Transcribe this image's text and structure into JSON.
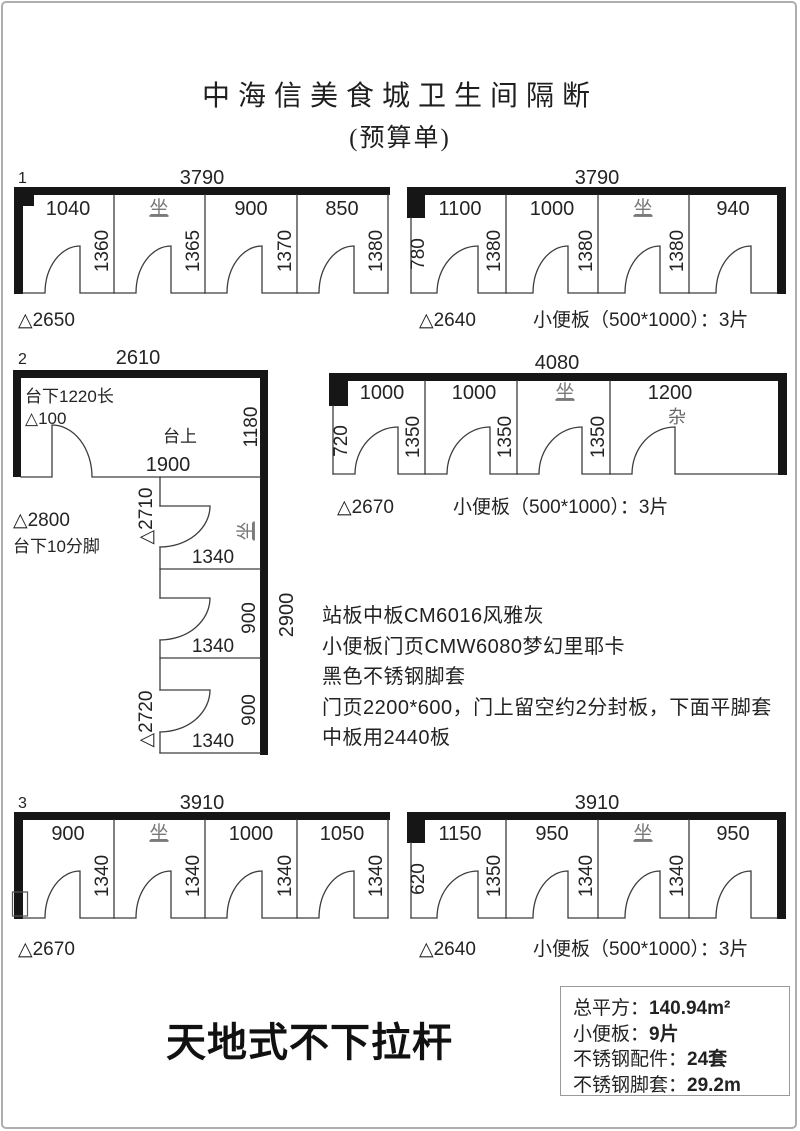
{
  "title": {
    "line1": "中海信美食城卫生间隔断",
    "line2": "(预算单)"
  },
  "ink_color": "#161616",
  "frame_color": "#aeaeae",
  "diagrams": {
    "d1": {
      "num": "1",
      "width_total": "3790",
      "floor_height": "△2650",
      "stalls": [
        {
          "w": "1040",
          "h": "1360"
        },
        {
          "w": "坐",
          "h": "1365"
        },
        {
          "w": "900",
          "h": "1370"
        },
        {
          "w": "850",
          "h": "1380"
        }
      ]
    },
    "d1r": {
      "width_total": "3790",
      "left_h": "780",
      "floor_height": "△2640",
      "urinal": "小便板（500*1000）：3片",
      "stalls": [
        {
          "w": "1100",
          "h": "1380"
        },
        {
          "w": "1000",
          "h": "1380"
        },
        {
          "w": "坐",
          "h": "1380"
        },
        {
          "w": "940",
          "h": ""
        }
      ]
    },
    "d2": {
      "num": "2",
      "width_total": "2610",
      "labels": {
        "under_counter": "台下1220长",
        "delta100": "△100",
        "counter_top": "台上",
        "right_h": "1180",
        "inner_w": "1900",
        "delta2800": "△2800",
        "feet": "台下10分脚",
        "delta2710": "△2710",
        "delta2720": "△2720",
        "col_h": "2900",
        "seat": "坐"
      },
      "stalls": [
        {
          "front": "1340",
          "side": ""
        },
        {
          "front": "1340",
          "side": "900"
        },
        {
          "front": "1340",
          "side": "900"
        }
      ]
    },
    "d2r": {
      "width_total": "4080",
      "left_h": "720",
      "floor_height": "△2670",
      "urinal": "小便板（500*1000）：3片",
      "misc": "杂",
      "stalls": [
        {
          "w": "1000",
          "h": "1350"
        },
        {
          "w": "1000",
          "h": "1350"
        },
        {
          "w": "坐",
          "h": "1350"
        },
        {
          "w": "1200",
          "h": ""
        }
      ]
    },
    "d3": {
      "num": "3",
      "width_total": "3910",
      "floor_height": "△2670",
      "stalls": [
        {
          "w": "900",
          "h": "1340"
        },
        {
          "w": "坐",
          "h": "1340"
        },
        {
          "w": "1000",
          "h": "1340"
        },
        {
          "w": "1050",
          "h": "1340"
        }
      ]
    },
    "d3r": {
      "width_total": "3910",
      "left_h": "620",
      "floor_height": "△2640",
      "urinal": "小便板（500*1000）：3片",
      "stalls": [
        {
          "w": "1150",
          "h": "1350"
        },
        {
          "w": "950",
          "h": "1340"
        },
        {
          "w": "坐",
          "h": "1340"
        },
        {
          "w": "950",
          "h": ""
        }
      ]
    }
  },
  "notes": {
    "lines": [
      "站板中板CM6016风雅灰",
      "小便板门页CMW6080梦幻里耶卡",
      "黑色不锈钢脚套",
      "门页2200*600，门上留空约2分封板，下面平脚套",
      "中板用2440板"
    ]
  },
  "footer": {
    "style_note": "天地式不下拉杆"
  },
  "summary": {
    "rows": [
      {
        "label": "总平方：",
        "value": "140.94m²"
      },
      {
        "label": "小便板：",
        "value": "9片"
      },
      {
        "label": "不锈钢配件：",
        "value": "24套"
      },
      {
        "label": "不锈钢脚套：",
        "value": "29.2m"
      }
    ]
  }
}
